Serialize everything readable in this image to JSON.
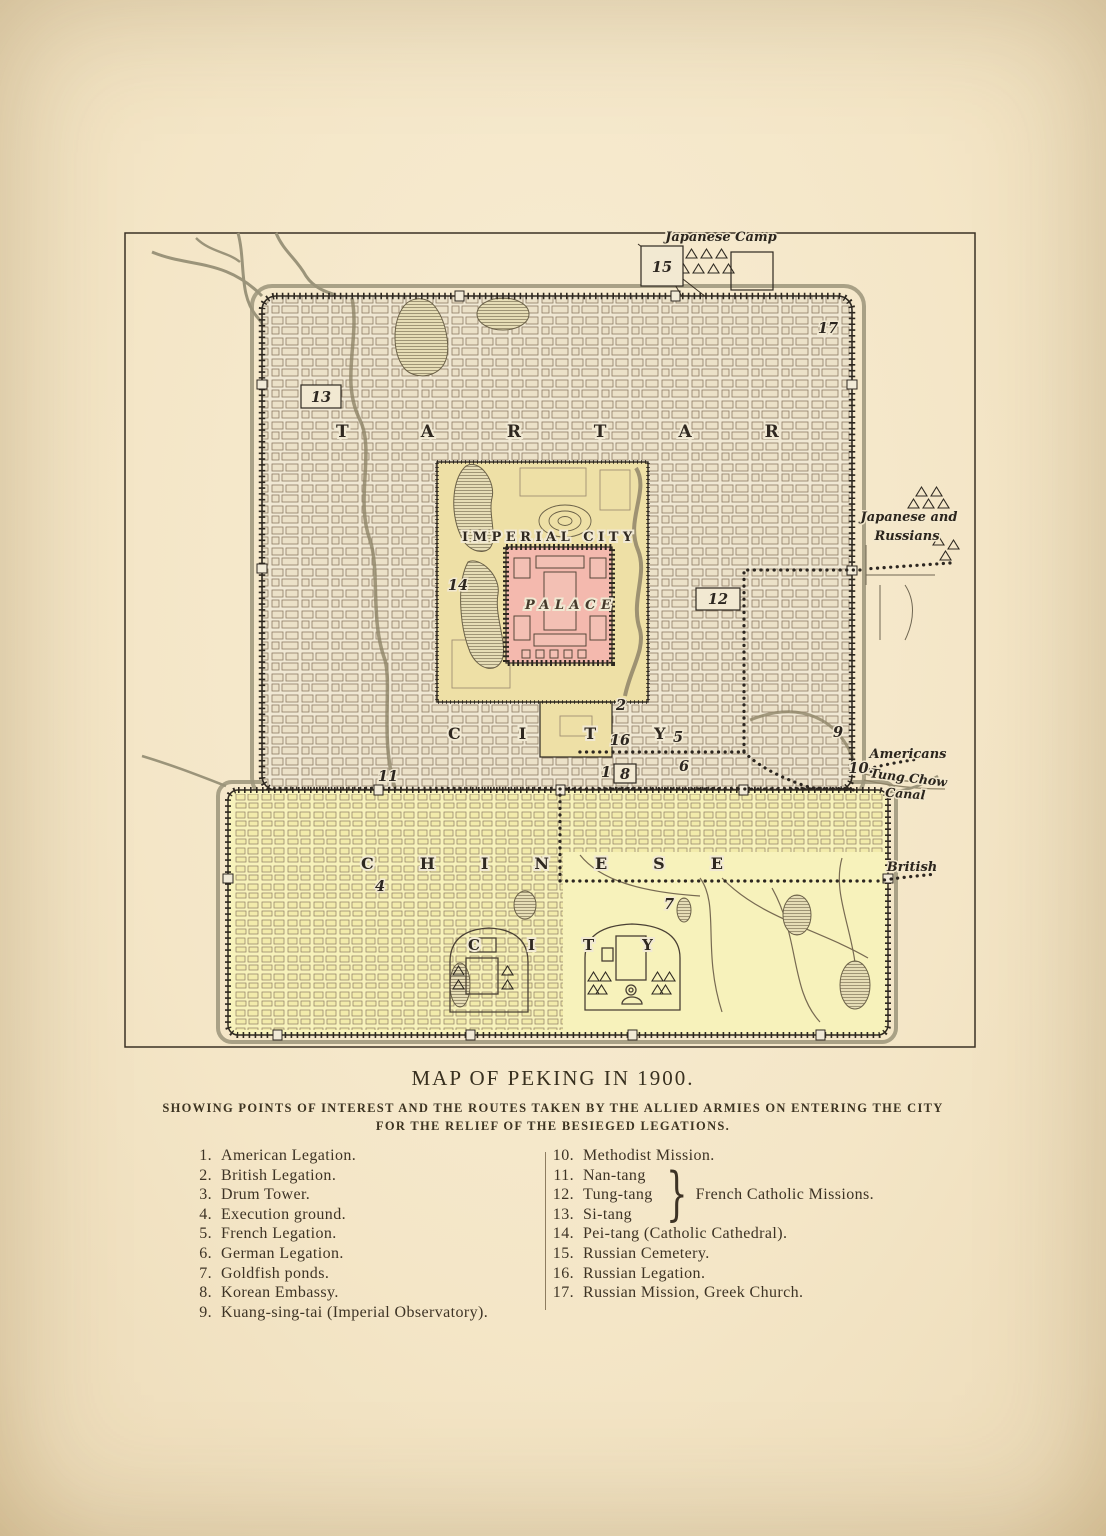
{
  "page": {
    "title": "MAP OF PEKING IN 1900.",
    "subtitle1": "SHOWING POINTS OF INTEREST AND THE ROUTES TAKEN BY THE ALLIED ARMIES ON ENTERING THE CITY",
    "subtitle2": "FOR THE RELIEF OF THE BESIEGED LEGATIONS."
  },
  "legend": {
    "left": [
      {
        "num": "1.",
        "label": "American Legation."
      },
      {
        "num": "2.",
        "label": "British Legation."
      },
      {
        "num": "3.",
        "label": "Drum Tower."
      },
      {
        "num": "4.",
        "label": "Execution ground."
      },
      {
        "num": "5.",
        "label": "French Legation."
      },
      {
        "num": "6.",
        "label": "German Legation."
      },
      {
        "num": "7.",
        "label": "Goldfish ponds."
      },
      {
        "num": "8.",
        "label": "Korean Embassy."
      },
      {
        "num": "9.",
        "label": "Kuang-sing-tai (Imperial Observatory)."
      }
    ],
    "right_top": [
      {
        "num": "10.",
        "label": "Methodist Mission."
      }
    ],
    "brace_group": {
      "items": [
        {
          "num": "11.",
          "label": "Nan-tang"
        },
        {
          "num": "12.",
          "label": "Tung-tang"
        },
        {
          "num": "13.",
          "label": "Si-tang"
        }
      ],
      "brace": "}",
      "label": "French Catholic Missions."
    },
    "right_bottom": [
      {
        "num": "14.",
        "label": "Pei-tang (Catholic Cathedral)."
      },
      {
        "num": "15.",
        "label": "Russian Cemetery."
      },
      {
        "num": "16.",
        "label": "Russian Legation."
      },
      {
        "num": "17.",
        "label": "Russian Mission, Greek Church."
      }
    ]
  },
  "map": {
    "region_labels": {
      "tartar": "TARTAR",
      "tartar_city": "CITY",
      "imperial_city": "IMPERIAL CITY",
      "palace": "PALACE",
      "chinese": "CHINESE",
      "chinese_city": "CITY"
    },
    "annotations": {
      "japanese_camp": "Japanese Camp",
      "japanese_and": "Japanese and",
      "russians": "Russians",
      "americans": "Americans",
      "tung_chow": "Tung Chow",
      "canal": "Canal",
      "british": "British"
    },
    "markers": [
      {
        "num": "15"
      },
      {
        "num": "13"
      },
      {
        "num": "17"
      },
      {
        "num": "14"
      },
      {
        "num": "12"
      },
      {
        "num": "2"
      },
      {
        "num": "16"
      },
      {
        "num": "5"
      },
      {
        "num": "1"
      },
      {
        "num": "8"
      },
      {
        "num": "6"
      },
      {
        "num": "9"
      },
      {
        "num": "10."
      },
      {
        "num": "11"
      },
      {
        "num": "4"
      },
      {
        "num": "7"
      }
    ]
  },
  "colors": {
    "paper": "#f4e6c7",
    "palace_pink": "#f4b9ae",
    "imperial_yellow": "#eee0a6",
    "chinese_yellow": "#f7f2bb",
    "ink": "#2e2820",
    "water": "#9b947a"
  }
}
